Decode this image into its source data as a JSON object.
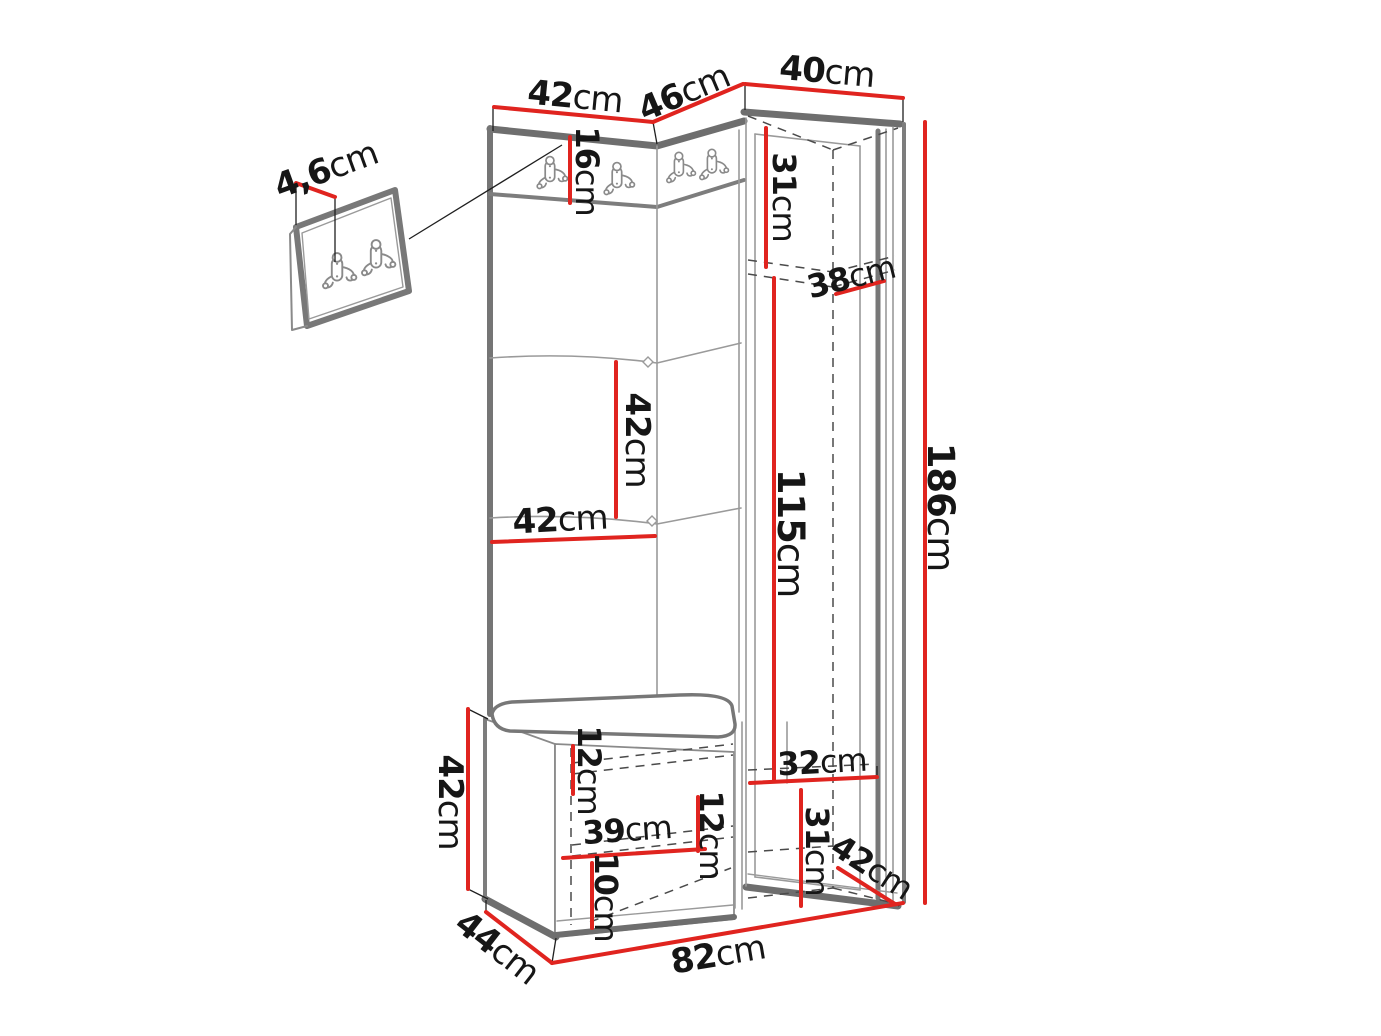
{
  "diagram": {
    "kind": "furniture-dimension-drawing",
    "background_color": "#ffffff",
    "dimension_line_color": "#e0241f",
    "outline_color": "#7d7d7d",
    "hidden_line_color": "#4a4a4a",
    "label_text_color": "#161616",
    "unit": "cm",
    "icons": [
      {
        "name": "coat-hook-icon",
        "description": "double coat hook glyph"
      }
    ]
  },
  "labels": [
    {
      "name": "panel-thickness",
      "value": "4,6",
      "unit": "cm",
      "x": 326,
      "y": 170,
      "rot": -20,
      "size": 34
    },
    {
      "name": "left-panel-width",
      "value": "42",
      "unit": "cm",
      "x": 575,
      "y": 97,
      "rot": 5.5,
      "size": 34
    },
    {
      "name": "corner-panel-width",
      "value": "46",
      "unit": "cm",
      "x": 684,
      "y": 93,
      "rot": -23,
      "size": 34
    },
    {
      "name": "wardrobe-width",
      "value": "40",
      "unit": "cm",
      "x": 827,
      "y": 72,
      "rot": 5,
      "size": 34
    },
    {
      "name": "hook-strip-height",
      "value": "16",
      "unit": "cm",
      "x": 587,
      "y": 171,
      "rot": 90,
      "size": 32
    },
    {
      "name": "top-compartment-height",
      "value": "31",
      "unit": "cm",
      "x": 784,
      "y": 197,
      "rot": 90,
      "size": 32
    },
    {
      "name": "shelf-depth",
      "value": "38",
      "unit": "cm",
      "x": 851,
      "y": 277,
      "rot": -14,
      "size": 32
    },
    {
      "name": "panel-square-height",
      "value": "42",
      "unit": "cm",
      "x": 637,
      "y": 440,
      "rot": 90,
      "size": 34
    },
    {
      "name": "panel-square-width",
      "value": "42",
      "unit": "cm",
      "x": 560,
      "y": 520,
      "rot": -3,
      "size": 34
    },
    {
      "name": "hanging-space-height",
      "value": "115",
      "unit": "cm",
      "x": 791,
      "y": 533,
      "rot": 90,
      "size": 37
    },
    {
      "name": "total-height",
      "value": "186",
      "unit": "cm",
      "x": 941,
      "y": 507,
      "rot": 90,
      "size": 37
    },
    {
      "name": "bench-height",
      "value": "42",
      "unit": "cm",
      "x": 450,
      "y": 802,
      "rot": 90,
      "size": 34
    },
    {
      "name": "bench-depth",
      "value": "44",
      "unit": "cm",
      "x": 497,
      "y": 948,
      "rot": 38,
      "size": 34
    },
    {
      "name": "bench-top-clearance",
      "value": "12",
      "unit": "cm",
      "x": 589,
      "y": 770,
      "rot": 90,
      "size": 32
    },
    {
      "name": "bench-inner-width",
      "value": "39",
      "unit": "cm",
      "x": 627,
      "y": 830,
      "rot": -4,
      "size": 32
    },
    {
      "name": "bench-right-clearance",
      "value": "12",
      "unit": "cm",
      "x": 711,
      "y": 835,
      "rot": 90,
      "size": 32
    },
    {
      "name": "bench-bottom-shelf",
      "value": "10",
      "unit": "cm",
      "x": 606,
      "y": 897,
      "rot": 90,
      "size": 32
    },
    {
      "name": "wardrobe-shelf-width",
      "value": "32",
      "unit": "cm",
      "x": 822,
      "y": 762,
      "rot": -3,
      "size": 32
    },
    {
      "name": "wardrobe-bottom-height",
      "value": "31",
      "unit": "cm",
      "x": 817,
      "y": 851,
      "rot": 90,
      "size": 32
    },
    {
      "name": "wardrobe-depth",
      "value": "42",
      "unit": "cm",
      "x": 872,
      "y": 867,
      "rot": 33,
      "size": 32
    },
    {
      "name": "total-width",
      "value": "82",
      "unit": "cm",
      "x": 718,
      "y": 955,
      "rot": -9.5,
      "size": 34
    }
  ]
}
